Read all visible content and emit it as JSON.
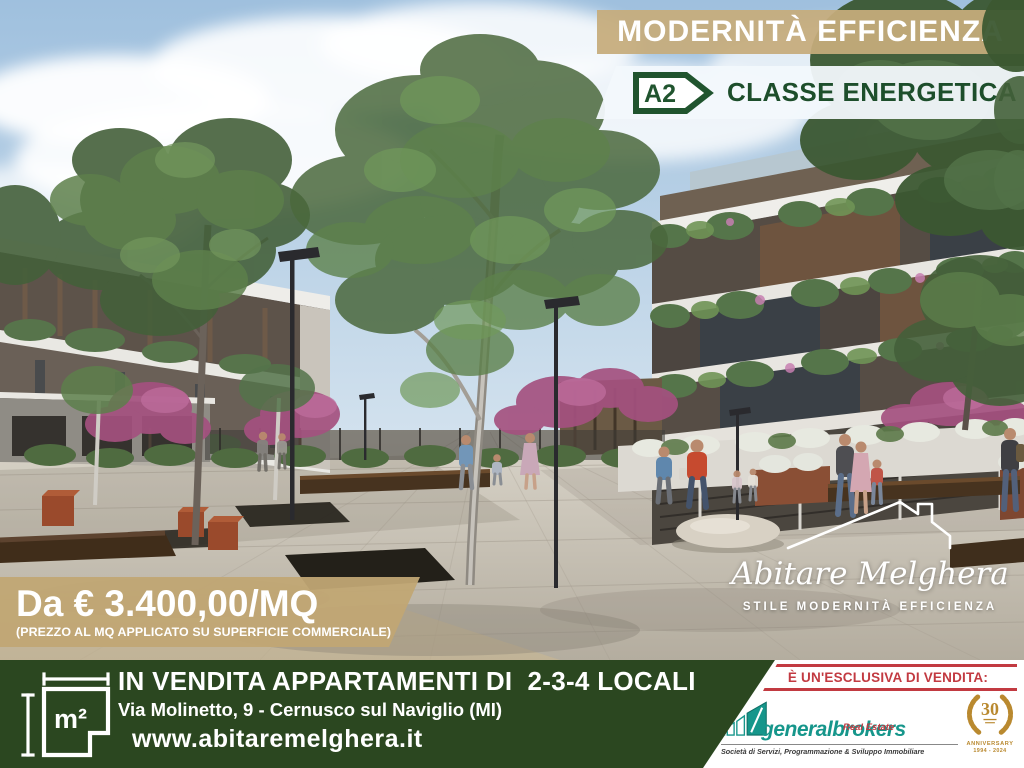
{
  "overlay": {
    "modernita_banner": "MODERNITÀ EFFICIENZA",
    "energy": {
      "class_code": "A2",
      "label": "CLASSE ENERGETICA"
    },
    "price": {
      "main": "Da € 3.400,00/MQ",
      "note": "(PREZZO AL MQ APPLICATO SU SUPERFICIE COMMERCIALE)"
    }
  },
  "brand": {
    "name": "Abitare Melghera",
    "tagline": "STILE MODERNITÀ EFFICIENZA"
  },
  "footer": {
    "sqm_symbol": "m²",
    "headline": "IN VENDITA APPARTAMENTI DI  2-3-4 LOCALI",
    "address": "Via Molinetto, 9 - Cernusco sul Naviglio (MI)",
    "website": "www.abitaremelghera.it"
  },
  "agency": {
    "exclusive_label": "È UN'ESCLUSIVA DI VENDITA:",
    "name": "generalbrokers",
    "division": "Real Estate",
    "tagline": "Società di Servizi, Programmazione & Sviluppo Immobiliare",
    "anniversary": {
      "number": "30",
      "label": "ANNIVERSARY",
      "years": "1994 - 2024"
    }
  },
  "colors": {
    "band_tan": "#c5ab7a",
    "footer_green": "#2b4720",
    "energy_green": "#1d4e2b",
    "accent_red": "#c23a41",
    "agency_teal": "#16968b",
    "gold": "#b9892f"
  }
}
